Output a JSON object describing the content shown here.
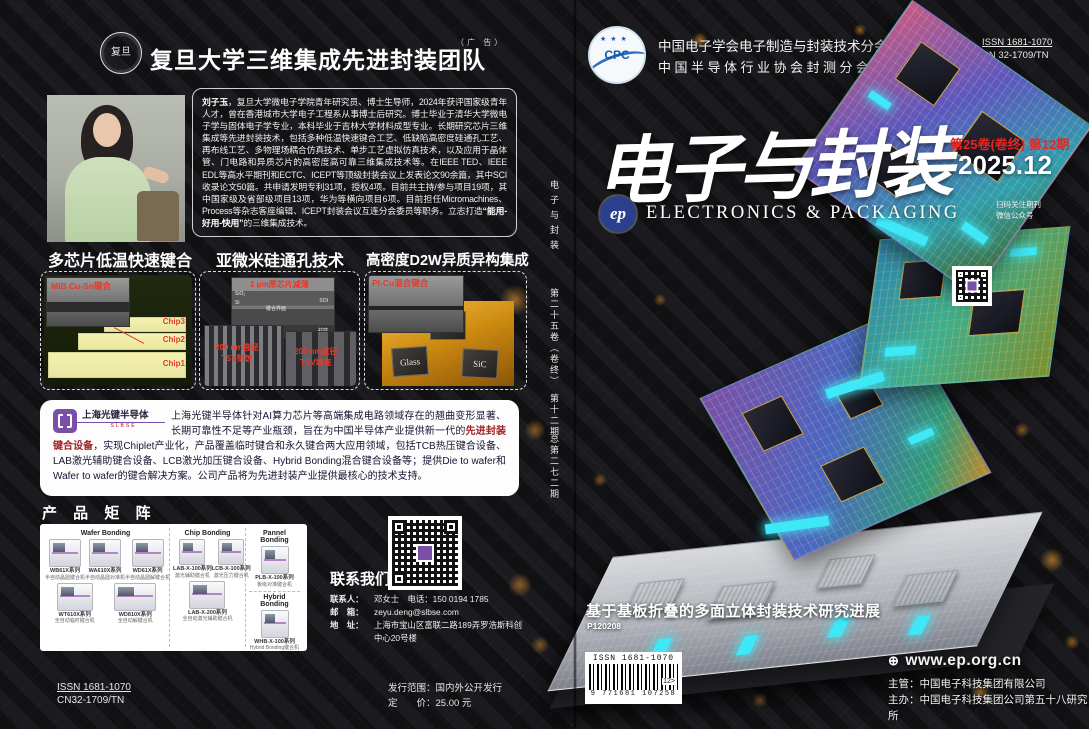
{
  "colors": {
    "accent_red": "#e8251f",
    "glow_orange": "#f09a2a",
    "connector_cyan": "#3fe8f6",
    "brand_purple": "#7a4fa8",
    "ep_blue": "#2b3f8f",
    "highlight_maroon": "#a02020"
  },
  "back_cover": {
    "header": {
      "seal_label": "复旦",
      "title": "复旦大学三维集成先进封装团队",
      "ad_note": "（广 告）"
    },
    "bio": {
      "name": "刘子玉",
      "body_1": "，复旦大学微电子学院青年研究员、博士生导师，2024年获评国家级青年人才，曾在香港城市大学电子工程系从事博士后研究。博士毕业于清华大学微电子学与固体电子学专业，本科毕业于吉林大学材料成型专业。长期研究芯片三维集成等先进封装技术，包括多种低温快速键合工艺、低缺陷高密度硅通孔工艺、再布线工艺、多物理场耦合仿真技术、单步工艺虚拟仿真技术，以及应用于晶体管、门电路和异质芯片的高密度高可靠三维集成技术等。在IEEE TED、IEEE EDL等高水平期刊和ECTC、ICEPT等顶级封装会议上发表论文90余篇，其中SCI收录论文50篇。共申请发明专利31项，授权4项。目前共主持/参与项目19项，其中国家级及省部级项目13项，华为等横向项目6项。目前担任Micromachines、Process等杂志客座编辑、ICEPT封装会议互连分会委员等职务。立志打造",
      "motto": "“能用-好用-快用”",
      "body_2": "的三维集成技术。"
    },
    "panels": [
      {
        "title": "多芯片低温快速键合",
        "inset_label": "MIB Cu-Sn键合",
        "chip_labels": [
          "Chip3",
          "Chip2",
          "Chip1"
        ]
      },
      {
        "title": "亚微米硅通孔技术",
        "top_label": "1 μm厚芯片减薄",
        "layer_labels": [
          "SiO₂",
          "Si",
          "键合界面",
          "SOI",
          "衬底"
        ],
        "left_label_1": "200 nm直径",
        "left_label_2": "TSV刻蚀",
        "right_label_1": "200 nm直径",
        "right_label_2": "TSV填充"
      },
      {
        "title": "高密度D2W异质异构集成",
        "inset_label": "PI-Cu混合键合",
        "chip_labels": [
          "GaN",
          "Glass",
          "SiC"
        ]
      }
    ],
    "company": {
      "logo_name": "上海光键半导体",
      "logo_sub": "SLBSE",
      "body_1": "上海光键半导体针对AI算力芯片等高端集成电路领域存在的翘曲变形显著、长期可靠性不足等产业瓶颈，旨在为中国半导体产业提供新一代的",
      "highlight": "先进封装键合设备",
      "body_2": "，实现Chiplet产业化，产品覆盖临时键合和永久键合两大应用领域，包括TCB热压键合设备、LAB激光辅助键合设备、LCB激光加压键合设备、Hybrid Bonding混合键合设备等；提供Die to wafer和Wafer to wafer的键合解决方案。公司产品将为先进封装产业提供最核心的技术支持。"
    },
    "product_matrix": {
      "title": "产 品 矩 阵",
      "groups": [
        {
          "name": "Wafer Bonding",
          "products": [
            {
              "model": "WB61X系列",
              "desc": "半自动晶圆键合机"
            },
            {
              "model": "WA610X系列",
              "desc": "半自动晶圆对准机"
            },
            {
              "model": "WD61X系列",
              "desc": "半自动晶圆解键合机"
            },
            {
              "model": "WT610X系列",
              "desc": "全自动临时键合机"
            },
            {
              "model": "WD810X系列",
              "desc": "全自动解键合机"
            }
          ]
        },
        {
          "name": "Chip Bonding",
          "products": [
            {
              "model": "LAB-X-100系列",
              "desc": "激光辅助键合机"
            },
            {
              "model": "LCB-X-100系列",
              "desc": "激光压力键合机"
            },
            {
              "model": "LAB-X-200系列",
              "desc": "全自动激光辅助键合机"
            }
          ]
        },
        {
          "name": "Pannel Bonding",
          "products": [
            {
              "model": "PLB-X-100系列",
              "desc": "板级对准键合机"
            }
          ]
        },
        {
          "name": "Hybrid Bonding",
          "products": [
            {
              "model": "WHB-X-100系列",
              "desc": "Hybrid Bonding键合机"
            }
          ]
        }
      ]
    },
    "contact": {
      "title": "联系我们",
      "lines": [
        {
          "label": "联系人：",
          "value": "邓女士　电话：150 0194 1785"
        },
        {
          "label": "邮　箱：",
          "value": "zeyu.deng@slbse.com"
        },
        {
          "label": "地　址：",
          "value": "上海市宝山区富联二路189弄罗浩斯科创中心20号楼"
        }
      ]
    },
    "footer": {
      "issn": "ISSN 1681-1070",
      "cn": "CN32-1709/TN",
      "dist_label": "发行范围：",
      "dist_value": "国内外公开发行",
      "price_label": "定　　价：",
      "price_value": "25.00 元"
    }
  },
  "front_cover": {
    "associations": {
      "line1": "中国电子学会电子制造与封装技术分会会刊",
      "line2": "中国半导体行业协会封测分会会刊"
    },
    "issn": "ISSN 1681-1070",
    "cn": "CN 32-1709/TN",
    "cpc_logo": "CPC",
    "cpc_stars": "★ ★ ★",
    "title_cn": "电子与封装",
    "volume_issue": "第25卷(卷终) 第12期",
    "date": "2025.12",
    "ep_logo": "ep",
    "title_en": "ELECTRONICS & PACKAGING",
    "qr_caption_line1": "扫码关注期刊",
    "qr_caption_line2": "微信公众号",
    "spine": {
      "title": "电子与封装",
      "volume": "第二十五卷（卷终）",
      "issue": "　第十二期",
      "cumulative": "总第二七二期"
    },
    "article": {
      "title": "基于基板折叠的多面立体封装技术研究进展",
      "code": "P120208"
    },
    "barcode": {
      "issn": "ISSN 1681-1070",
      "digits": "9 771681 107258",
      "suffix": "12>"
    },
    "footer": {
      "website": "www.ep.org.cn",
      "supervisor_label": "主管：",
      "supervisor": "中国电子科技集团有限公司",
      "organizer_label": "主办：",
      "organizer": "中国电子科技集团公司第五十八研究所"
    }
  }
}
